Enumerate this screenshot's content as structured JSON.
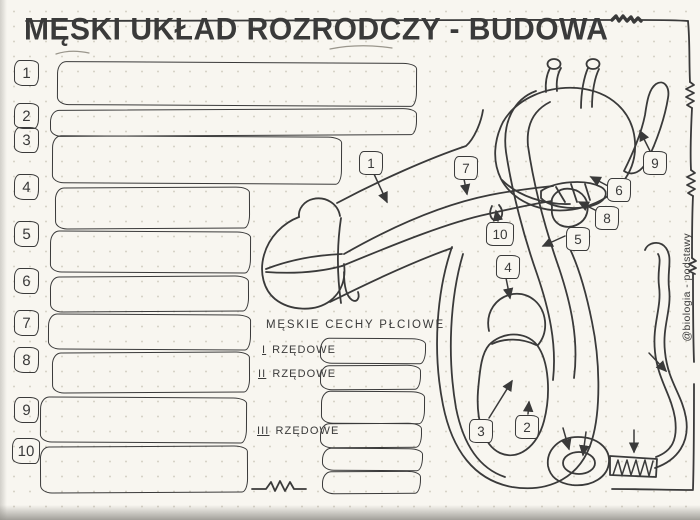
{
  "title": "MĘSKI UKŁAD ROZRODCZY - BUDOWA",
  "colors": {
    "ink": "#3a3a3a",
    "paper": "#f8f6f0",
    "dots": "#d7d3c7"
  },
  "left_list": {
    "items": [
      {
        "number": "1",
        "value": ""
      },
      {
        "number": "2",
        "value": ""
      },
      {
        "number": "3",
        "value": ""
      },
      {
        "number": "4",
        "value": ""
      },
      {
        "number": "5",
        "value": ""
      },
      {
        "number": "6",
        "value": ""
      },
      {
        "number": "7",
        "value": ""
      },
      {
        "number": "8",
        "value": ""
      },
      {
        "number": "9",
        "value": ""
      },
      {
        "number": "10",
        "value": ""
      }
    ]
  },
  "traits_section": {
    "header": "MĘSKIE CECHY PŁCIOWE",
    "rows": [
      {
        "numeral": "I",
        "label": "RZĘDOWE",
        "value": ""
      },
      {
        "numeral": "II",
        "label": "RZĘDOWE",
        "value": ""
      },
      {
        "numeral": "III",
        "label": "RZĘDOWE",
        "value": ""
      }
    ]
  },
  "diagram": {
    "callouts": [
      {
        "number": "1"
      },
      {
        "number": "2"
      },
      {
        "number": "3"
      },
      {
        "number": "4"
      },
      {
        "number": "5"
      },
      {
        "number": "6"
      },
      {
        "number": "7"
      },
      {
        "number": "8"
      },
      {
        "number": "9"
      },
      {
        "number": "10"
      }
    ]
  },
  "watermark": "@biologia - podstawy"
}
